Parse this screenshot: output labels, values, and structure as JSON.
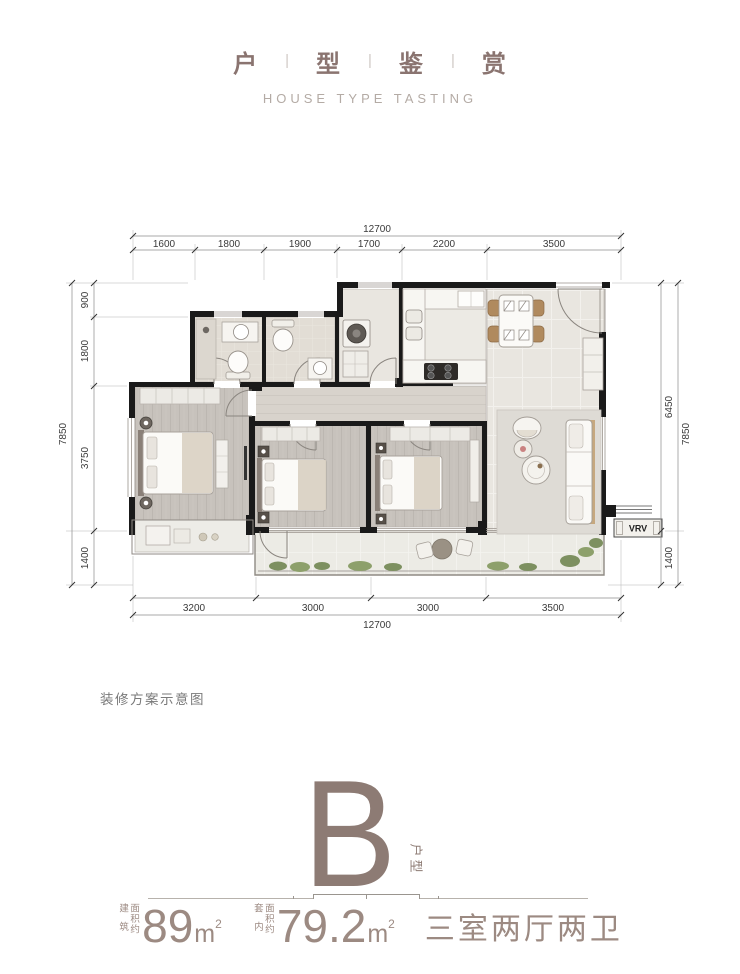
{
  "header": {
    "title_chars": [
      "户",
      "型",
      "鉴",
      "赏"
    ],
    "separator": "|",
    "subtitle": "HOUSE TYPE TASTING"
  },
  "caption": "装修方案示意图",
  "unit": {
    "letter": "B",
    "type_label": "户型"
  },
  "stats": {
    "area_build": {
      "label_col1": "建筑",
      "label_col2": "面积约",
      "value": "89",
      "unit": "m",
      "sup": "2"
    },
    "area_inner": {
      "label_col1": "套内",
      "label_col2": "面积约",
      "value": "79.2",
      "unit": "m",
      "sup": "2"
    },
    "layout": "三室两厅两卫"
  },
  "plan": {
    "vrv_label": "VRV",
    "dims": {
      "top_total": "12700",
      "top_segments": [
        "1600",
        "1800",
        "1900",
        "1700",
        "2200",
        "3500"
      ],
      "left_total": "7850",
      "left_segments": [
        "900",
        "1800",
        "3750",
        "1400"
      ],
      "right_total": "7850",
      "right_segments": [
        "6450",
        "1400"
      ],
      "bottom_total": "12700",
      "bottom_segments": [
        "3200",
        "3000",
        "3000",
        "3500"
      ]
    }
  },
  "colors": {
    "accent": "#8d7b74",
    "title_text": "#8a7470",
    "subtitle_text": "#b4aba5",
    "dim_text": "#3a3a3a",
    "wall": "#1a1a1a",
    "greenery": "#7d9060",
    "stats_text": "#9c8a82"
  }
}
